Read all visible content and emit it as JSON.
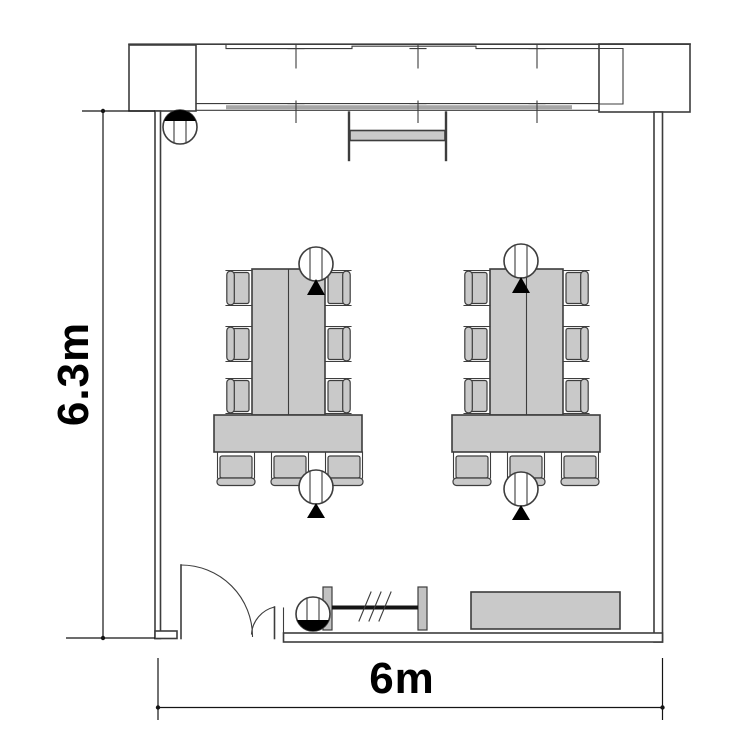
{
  "dimension_labels": {
    "height": "6.3m",
    "width": "6m"
  },
  "colors": {
    "line": "#3d3d3d",
    "dimension": "#141414",
    "furniture_fill": "#c9c9c9",
    "window_sill": "#a6a6a6",
    "rack_post_fill": "#c2c2c2",
    "symbol_black": "#000000",
    "background": "#ffffff"
  },
  "symbols": {
    "window_band": "sliding-window-band",
    "projection_screen": "wall-screen",
    "ceiling_device": "circle-with-vertical-lines",
    "direction_marker": "solid-triangle",
    "door": "double-leaf-swing-door",
    "coat_rack": "rail-with-hatch-marks",
    "cabinet": "low-cabinet"
  },
  "furniture_counts": {
    "table_groups": 2,
    "side_chairs_per_group": 6,
    "end_chairs_per_group": 3,
    "ceiling_device_markers": 4
  }
}
